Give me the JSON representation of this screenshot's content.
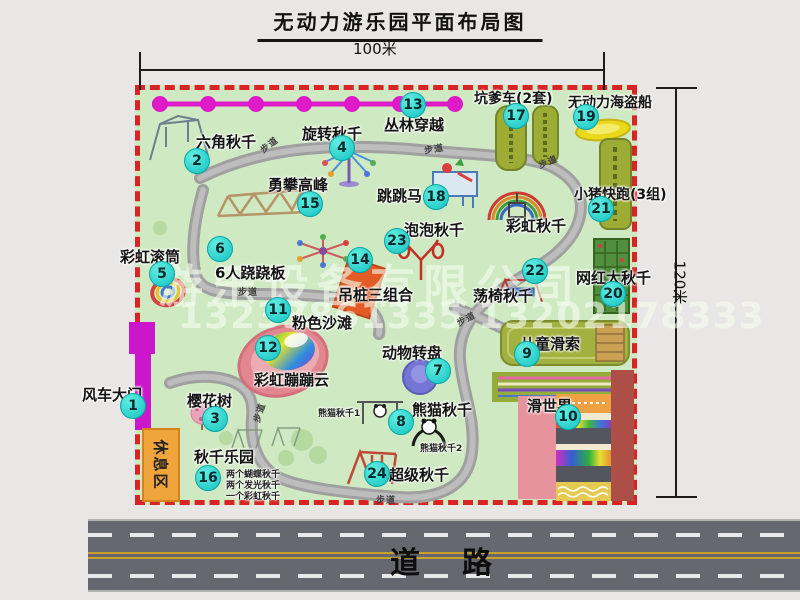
{
  "title": "无动力游乐园平面布局图",
  "dimensions": {
    "width": "100米",
    "height": "120米"
  },
  "watermark": {
    "company": "游乐设备有限公司",
    "phones": "13233861335 13202178333"
  },
  "road": {
    "label": "道　路"
  },
  "park": {
    "trail_label": "步道",
    "rest_area_label": "休息区",
    "rainbow_swing_label": "彩虹秋千",
    "panda_swing_1_label": "熊猫秋千1",
    "panda_swing_2_label": "熊猫秋千2",
    "swing_park_details": [
      "两个蝴蝶秋千",
      "两个发光秋千",
      "一个彩虹秋千"
    ],
    "items": [
      {
        "num": "1",
        "label": "风车大门"
      },
      {
        "num": "2",
        "label": "六角秋千"
      },
      {
        "num": "3",
        "label": "樱花树"
      },
      {
        "num": "4",
        "label": "旋转秋千"
      },
      {
        "num": "5",
        "label": "彩虹滚筒"
      },
      {
        "num": "6",
        "label": "6人跷跷板"
      },
      {
        "num": "7",
        "label": "动物转盘"
      },
      {
        "num": "8",
        "label": "熊猫秋千"
      },
      {
        "num": "9",
        "label": "儿童滑索"
      },
      {
        "num": "10",
        "label": "滑世界"
      },
      {
        "num": "11",
        "label": "粉色沙滩"
      },
      {
        "num": "12",
        "label": "彩虹蹦蹦云"
      },
      {
        "num": "13",
        "label": "丛林穿越"
      },
      {
        "num": "14",
        "label": "吊桩三组合"
      },
      {
        "num": "15",
        "label": "勇攀高峰"
      },
      {
        "num": "16",
        "label": "秋千乐园"
      },
      {
        "num": "17",
        "label": "坑爹车(2套)"
      },
      {
        "num": "18",
        "label": "跳跳马"
      },
      {
        "num": "19",
        "label": "无动力海盗船"
      },
      {
        "num": "20",
        "label": "网红大秋千"
      },
      {
        "num": "21",
        "label": "小猪快跑(3组)"
      },
      {
        "num": "22",
        "label": "荡椅秋千"
      },
      {
        "num": "23",
        "label": "泡泡秋千"
      },
      {
        "num": "24",
        "label": "超级秋千"
      }
    ],
    "colors": {
      "border": "#d82424",
      "ground": "#cfe9c2",
      "badge": "#2fd6cd",
      "gate": "#cc16cc",
      "rest_area": "#f0a43c",
      "road": "#67676f"
    }
  }
}
